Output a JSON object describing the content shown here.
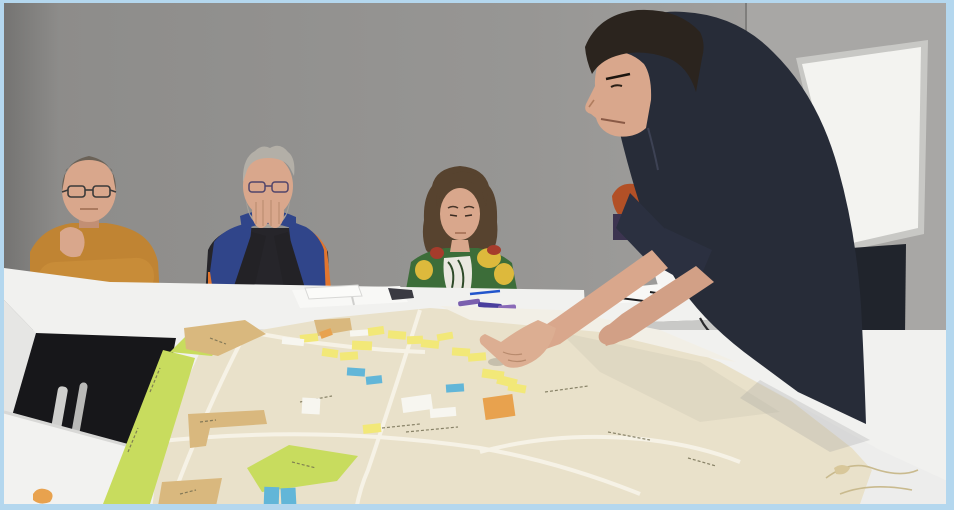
{
  "scene": {
    "type": "photograph",
    "description": "Participatory urban-planning workshop: three seated participants watch a standing facilitator lean over white tables and point at a large street map covered with yellow and blue sticky notes; a whiteboard hangs on the grey wall behind him.",
    "text_visible": "none legible (tiny blurred street labels on the map only)"
  },
  "colors": {
    "frame": "#b4d7ee",
    "wall_left": "#8c8b89",
    "wall_right": "#a8a7a5",
    "wall_corner": "#7f7e7c",
    "whiteboard_frame": "#c8c8c5",
    "whiteboard_face": "#f3f3f0",
    "table_top": "#f1f1ef",
    "table_edge": "#d2d2d0",
    "table_side": "#e6e6e4",
    "table_gap": "#17171a",
    "table_leg": "#cfcfcd",
    "map_paper": "#e9e1ca",
    "map_paper_curl": "#f2efe6",
    "map_road": "#f7f3e8",
    "map_green": "#c8dc5e",
    "map_tan": "#d9b87e",
    "map_text": "#8a8372",
    "sticky_yellow": "#f2e878",
    "sticky_blue": "#62b6d8",
    "sticky_white": "#f7f6f0",
    "sticky_orange": "#e8a24e",
    "skin": "#d9a78c",
    "skin_dark": "#c28f74",
    "man1_sweater": "#c08433",
    "man1_hair": "#6b6257",
    "man2_vest": "#30458a",
    "man2_vest_orange": "#e2762f",
    "man2_sweater": "#26252a",
    "man2_hair": "#b3afa7",
    "man2_beard": "#a7a29a",
    "woman_hair": "#57432f",
    "woman_top_green": "#3c6d39",
    "woman_top_yellow": "#ddb93c",
    "woman_top_red": "#a63c2c",
    "woman_top_white": "#eae8e0",
    "stand_shirt": "#272c38",
    "stand_sleeve": "#2b3040",
    "stand_hair": "#2b241e",
    "jeans": "#20242c",
    "red_hair": "#b25026",
    "white_jacket": "#f6f5f3",
    "polka_case": "#8e2430",
    "pen_blue": "#2255cc",
    "cable": "#26262a",
    "paper": "#f8f8f6",
    "notebook_cover": "#3a3a42",
    "cord": "#c9ba8e"
  },
  "people": [
    {
      "id": "seated-man-mustard",
      "position": "far left",
      "appearance": "older man, balding with short grey hair, glasses, mustard long-sleeve sweater, arms folded on table"
    },
    {
      "id": "seated-man-vest",
      "position": "centre left",
      "appearance": "grey-haired bearded man with glasses, navy puffer vest with orange lining over black sweater, hands clasped in front of mouth"
    },
    {
      "id": "seated-woman",
      "position": "centre",
      "appearance": "woman with brown curly hair looking down, colourful green/yellow/red floral top"
    },
    {
      "id": "standing-facilitator",
      "position": "right",
      "appearance": "dark-haired man in dark navy shirt and jeans, leaning over the table pointing at the map"
    },
    {
      "id": "partially-hidden-person",
      "position": "behind facilitator",
      "appearance": "only red-orange hair visible behind the facilitator's arms"
    }
  ],
  "map": {
    "description": "large cream paper street map laid across white tables with green park zones, tan building blocks, white roads and many sticky notes",
    "sticky_notes": [
      {
        "x": 300,
        "y": 334,
        "w": 18,
        "h": 8,
        "r": -6,
        "c": "yellow"
      },
      {
        "x": 322,
        "y": 349,
        "w": 16,
        "h": 8,
        "r": 8,
        "c": "yellow"
      },
      {
        "x": 340,
        "y": 352,
        "w": 18,
        "h": 8,
        "r": -4,
        "c": "yellow"
      },
      {
        "x": 352,
        "y": 341,
        "w": 20,
        "h": 9,
        "r": 3,
        "c": "yellow"
      },
      {
        "x": 368,
        "y": 327,
        "w": 16,
        "h": 8,
        "r": -8,
        "c": "yellow"
      },
      {
        "x": 388,
        "y": 331,
        "w": 18,
        "h": 8,
        "r": 5,
        "c": "yellow"
      },
      {
        "x": 407,
        "y": 336,
        "w": 16,
        "h": 8,
        "r": -3,
        "c": "yellow"
      },
      {
        "x": 421,
        "y": 340,
        "w": 18,
        "h": 8,
        "r": 6,
        "c": "yellow"
      },
      {
        "x": 437,
        "y": 333,
        "w": 16,
        "h": 7,
        "r": -10,
        "c": "yellow"
      },
      {
        "x": 452,
        "y": 348,
        "w": 18,
        "h": 8,
        "r": 4,
        "c": "yellow"
      },
      {
        "x": 468,
        "y": 353,
        "w": 18,
        "h": 8,
        "r": -5,
        "c": "yellow"
      },
      {
        "x": 482,
        "y": 370,
        "w": 22,
        "h": 9,
        "r": 8,
        "c": "yellow"
      },
      {
        "x": 497,
        "y": 377,
        "w": 20,
        "h": 9,
        "r": 14,
        "c": "yellow"
      },
      {
        "x": 508,
        "y": 384,
        "w": 18,
        "h": 8,
        "r": 10,
        "c": "yellow"
      },
      {
        "x": 363,
        "y": 424,
        "w": 18,
        "h": 9,
        "r": -6,
        "c": "yellow"
      },
      {
        "x": 347,
        "y": 368,
        "w": 18,
        "h": 8,
        "r": 4,
        "c": "blue"
      },
      {
        "x": 366,
        "y": 376,
        "w": 16,
        "h": 8,
        "r": -6,
        "c": "blue"
      },
      {
        "x": 446,
        "y": 384,
        "w": 18,
        "h": 8,
        "r": -4,
        "c": "blue"
      },
      {
        "x": 264,
        "y": 487,
        "w": 15,
        "h": 19,
        "r": 2,
        "c": "blue"
      },
      {
        "x": 281,
        "y": 488,
        "w": 15,
        "h": 19,
        "r": -3,
        "c": "blue"
      },
      {
        "x": 402,
        "y": 396,
        "w": 30,
        "h": 15,
        "r": -8,
        "c": "white"
      },
      {
        "x": 430,
        "y": 408,
        "w": 26,
        "h": 9,
        "r": -5,
        "c": "white"
      },
      {
        "x": 282,
        "y": 338,
        "w": 22,
        "h": 7,
        "r": 6,
        "c": "white"
      },
      {
        "x": 350,
        "y": 330,
        "w": 18,
        "h": 6,
        "r": -4,
        "c": "white"
      },
      {
        "x": 302,
        "y": 398,
        "w": 18,
        "h": 16,
        "r": 3,
        "c": "white"
      },
      {
        "x": 484,
        "y": 396,
        "w": 30,
        "h": 22,
        "r": -8,
        "c": "orange"
      },
      {
        "x": 320,
        "y": 330,
        "w": 12,
        "h": 7,
        "r": -20,
        "c": "orange"
      }
    ]
  }
}
